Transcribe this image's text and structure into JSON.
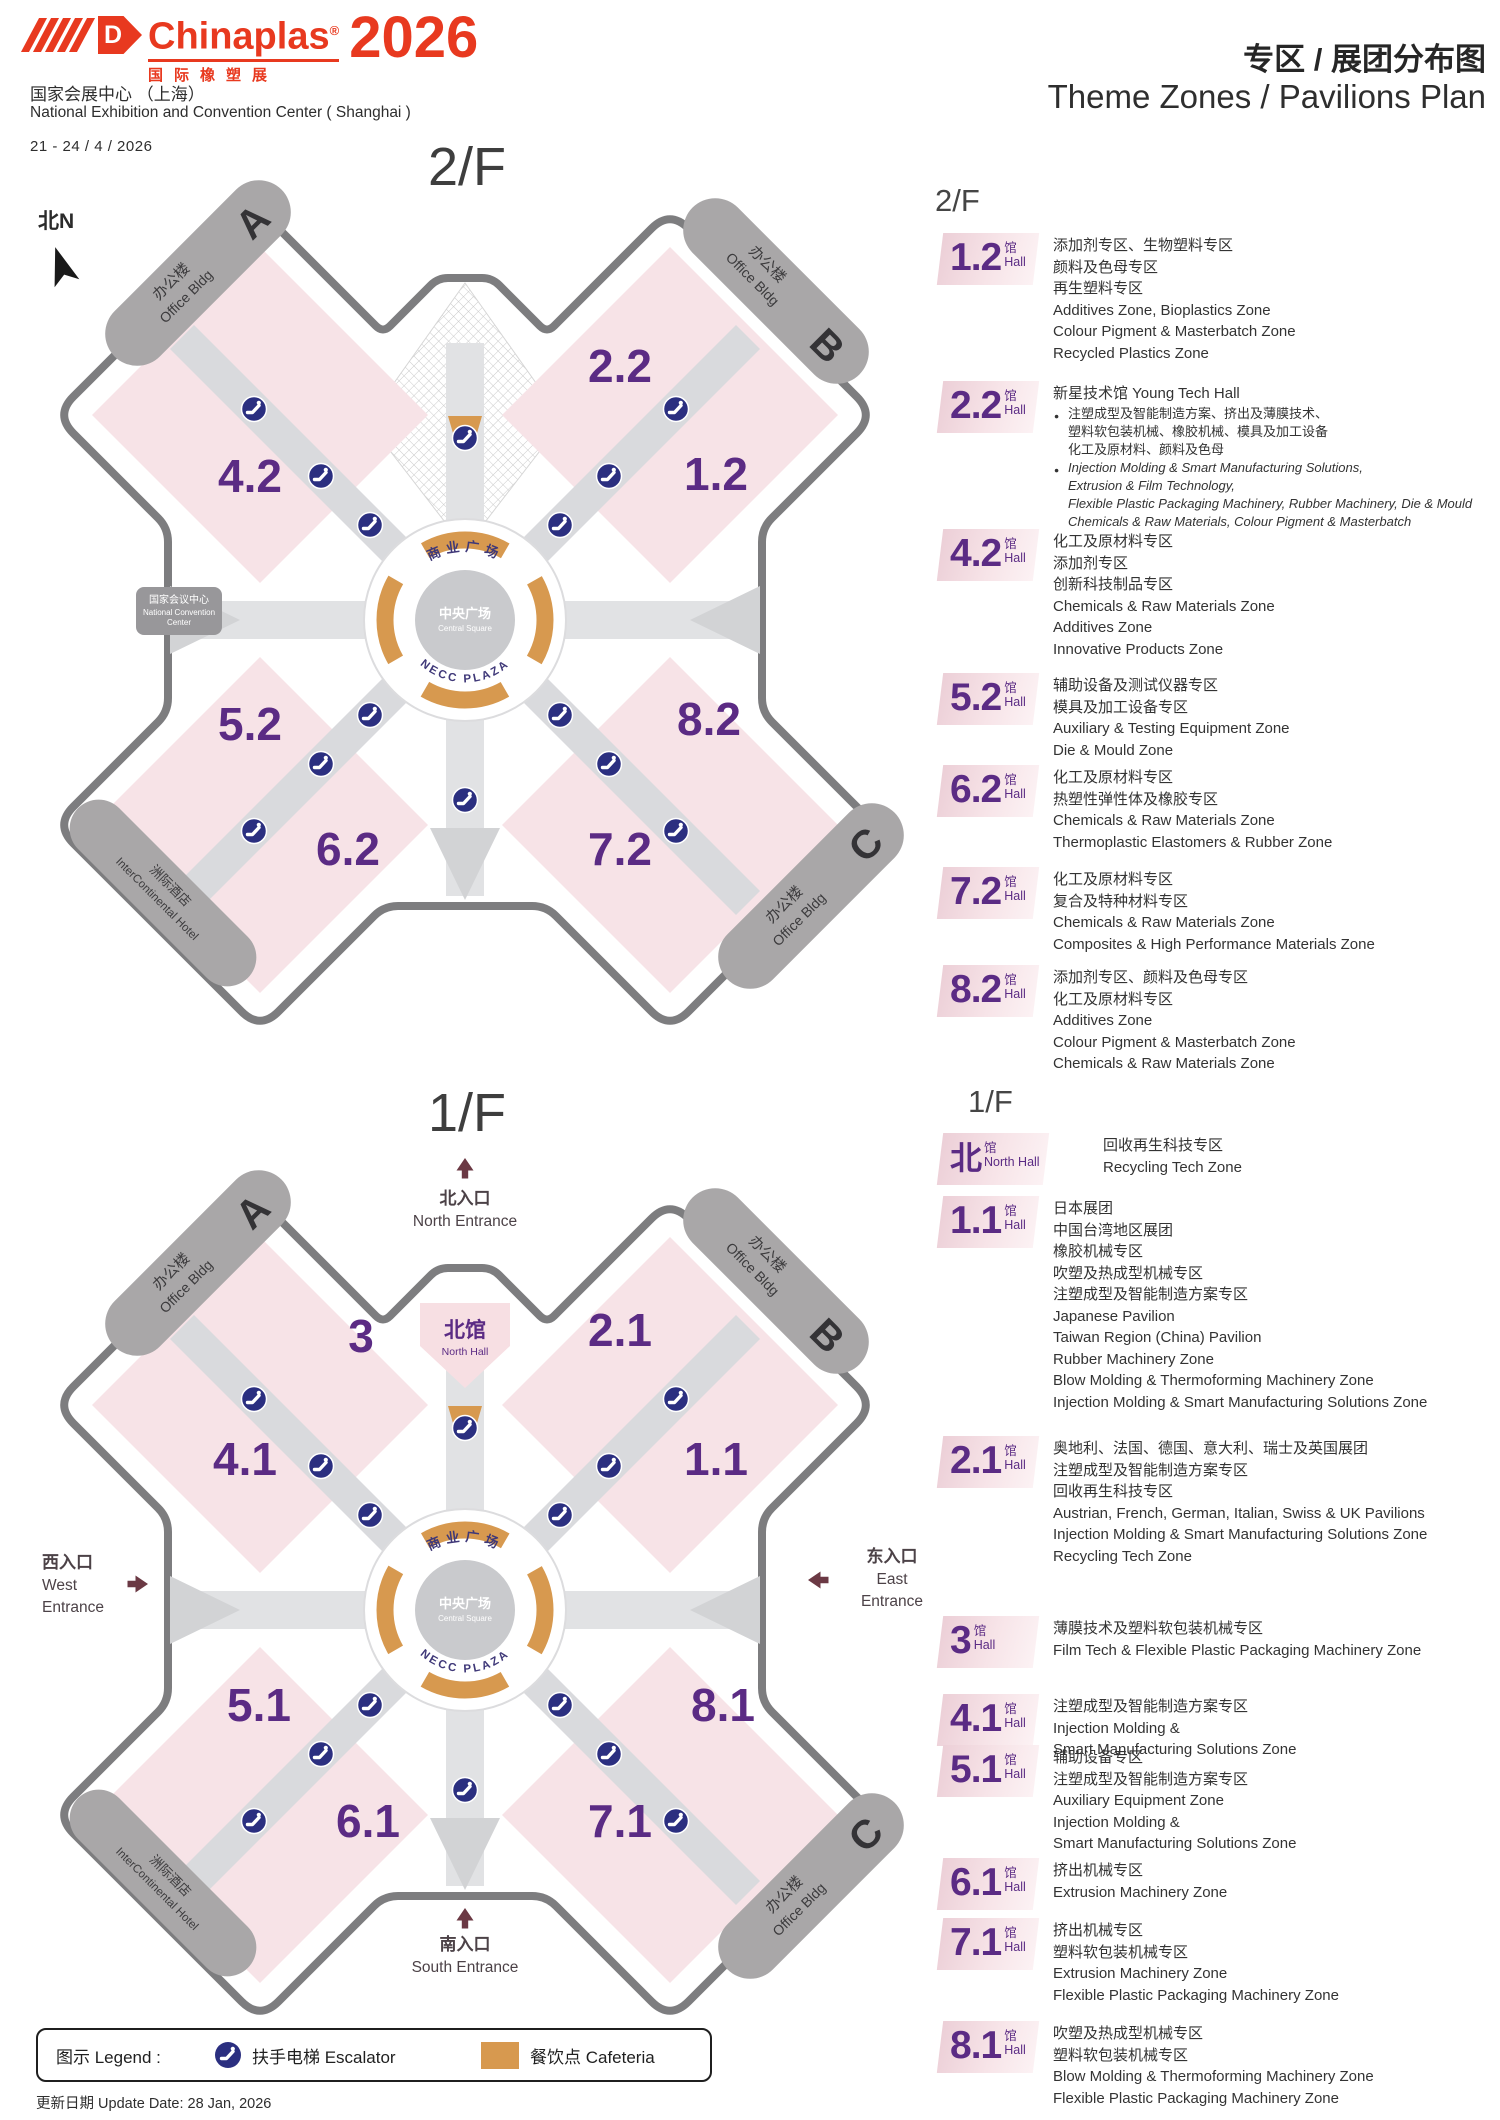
{
  "header": {
    "brand": "Chinaplas",
    "reg": "®",
    "brand_cn": "国际橡塑展",
    "year": "2026",
    "logo_d": "D",
    "venue_cn": "国家会展中心 （上海）",
    "venue_en": "National Exhibition and Convention Center ( Shanghai )",
    "dates": "21 - 24 / 4 / 2026",
    "title_cn": "专区 / 展团分布图",
    "title_en": "Theme Zones / Pavilions Plan"
  },
  "colors": {
    "brand_red": "#e8391f",
    "hall_purple": "#5b2b84",
    "hall_pink": "#f7e3e7",
    "cafeteria_orange": "#d7994f",
    "escalator_navy": "#2b2f80",
    "building_gray": "#a9a7a8",
    "outline_gray": "#7d7d7f"
  },
  "maps": {
    "common": {
      "plaza": {
        "arc_top": "商业广场",
        "center_cn": "中央广场",
        "center_en": "Central Square",
        "arc_bottom": "NECC PLAZA"
      },
      "buildings": {
        "office_cn": "办公楼",
        "office_en": "Office Bldg",
        "a": "A",
        "b": "B",
        "c": "C",
        "hotel_cn": "洲际酒店",
        "hotel_en": "InterContinental Hotel"
      }
    },
    "floor2": {
      "title": "2/F",
      "compass": "北N",
      "ncc": [
        "国家会议中心",
        "National Convention",
        "Center"
      ],
      "halls": [
        {
          "label": "2.2",
          "x": 602,
          "y": 242
        },
        {
          "label": "1.2",
          "x": 698,
          "y": 350
        },
        {
          "label": "4.2",
          "x": 232,
          "y": 352
        },
        {
          "label": "5.2",
          "x": 232,
          "y": 600
        },
        {
          "label": "8.2",
          "x": 691,
          "y": 595
        },
        {
          "label": "6.2",
          "x": 330,
          "y": 725
        },
        {
          "label": "7.2",
          "x": 602,
          "y": 725
        }
      ]
    },
    "floor1": {
      "title": "1/F",
      "north_hall_cn": "北馆",
      "north_hall_en": "North Hall",
      "halls": [
        {
          "label": "3",
          "x": 343,
          "y": 222
        },
        {
          "label": "2.1",
          "x": 602,
          "y": 216
        },
        {
          "label": "4.1",
          "x": 227,
          "y": 345
        },
        {
          "label": "1.1",
          "x": 698,
          "y": 345
        },
        {
          "label": "5.1",
          "x": 241,
          "y": 591
        },
        {
          "label": "8.1",
          "x": 705,
          "y": 591
        },
        {
          "label": "6.1",
          "x": 350,
          "y": 707
        },
        {
          "label": "7.1",
          "x": 602,
          "y": 707
        }
      ],
      "entrances": {
        "north": {
          "cn": "北入口",
          "en": "North Entrance"
        },
        "south": {
          "cn": "南入口",
          "en": "South Entrance"
        },
        "west": {
          "cn": "西入口",
          "en_l1": "West",
          "en_l2": "Entrance"
        },
        "east": {
          "cn": "东入口",
          "en_l1": "East",
          "en_l2": "Entrance"
        }
      }
    }
  },
  "legend2f": {
    "heading": "2/F",
    "entries": [
      {
        "num": "1.2",
        "unit": "馆",
        "unit2": "Hall",
        "lines": [
          {
            "t": "添加剂专区、生物塑料专区",
            "s": "cn"
          },
          {
            "t": "颜料及色母专区",
            "s": "cn"
          },
          {
            "t": "再生塑料专区",
            "s": "cn"
          },
          {
            "t": "Additives Zone, Bioplastics Zone",
            "s": "en"
          },
          {
            "t": "Colour Pigment & Masterbatch Zone",
            "s": "en"
          },
          {
            "t": "Recycled Plastics Zone",
            "s": "en"
          }
        ]
      },
      {
        "num": "2.2",
        "unit": "馆",
        "unit2": "Hall",
        "lines": [
          {
            "t": "新星技术馆 Young Tech Hall",
            "s": "cn"
          },
          {
            "t": "注塑成型及智能制造方案、挤出及薄膜技术、",
            "s": "bcn",
            "b": 1
          },
          {
            "t": "塑料软包装机械、橡胶机械、模具及加工设备",
            "s": "bcn"
          },
          {
            "t": "化工及原材料、颜料及色母",
            "s": "bcn"
          },
          {
            "t": "Injection Molding & Smart Manufacturing Solutions,",
            "s": "ben",
            "b": 1
          },
          {
            "t": "Extrusion & Film Technology,",
            "s": "ben"
          },
          {
            "t": "Flexible Plastic Packaging Machinery, Rubber Machinery, Die & Mould",
            "s": "ben"
          },
          {
            "t": "Chemicals & Raw Materials, Colour Pigment & Masterbatch",
            "s": "ben"
          }
        ]
      },
      {
        "num": "4.2",
        "unit": "馆",
        "unit2": "Hall",
        "lines": [
          {
            "t": "化工及原材料专区",
            "s": "cn"
          },
          {
            "t": "添加剂专区",
            "s": "cn"
          },
          {
            "t": "创新科技制品专区",
            "s": "cn"
          },
          {
            "t": "Chemicals & Raw Materials Zone",
            "s": "en"
          },
          {
            "t": "Additives Zone",
            "s": "en"
          },
          {
            "t": "Innovative Products Zone",
            "s": "en"
          }
        ]
      },
      {
        "num": "5.2",
        "unit": "馆",
        "unit2": "Hall",
        "lines": [
          {
            "t": "辅助设备及测试仪器专区",
            "s": "cn"
          },
          {
            "t": "模具及加工设备专区",
            "s": "cn"
          },
          {
            "t": "Auxiliary & Testing Equipment Zone",
            "s": "en"
          },
          {
            "t": "Die & Mould Zone",
            "s": "en"
          }
        ]
      },
      {
        "num": "6.2",
        "unit": "馆",
        "unit2": "Hall",
        "lines": [
          {
            "t": "化工及原材料专区",
            "s": "cn"
          },
          {
            "t": "热塑性弹性体及橡胶专区",
            "s": "cn"
          },
          {
            "t": "Chemicals & Raw Materials Zone",
            "s": "en"
          },
          {
            "t": "Thermoplastic Elastomers & Rubber Zone",
            "s": "en"
          }
        ]
      },
      {
        "num": "7.2",
        "unit": "馆",
        "unit2": "Hall",
        "lines": [
          {
            "t": "化工及原材料专区",
            "s": "cn"
          },
          {
            "t": "复合及特种材料专区",
            "s": "cn"
          },
          {
            "t": "Chemicals & Raw Materials Zone",
            "s": "en"
          },
          {
            "t": "Composites & High Performance Materials Zone",
            "s": "en"
          }
        ]
      },
      {
        "num": "8.2",
        "unit": "馆",
        "unit2": "Hall",
        "lines": [
          {
            "t": "添加剂专区、颜料及色母专区",
            "s": "cn"
          },
          {
            "t": "化工及原材料专区",
            "s": "cn"
          },
          {
            "t": "Additives Zone",
            "s": "en"
          },
          {
            "t": "Colour Pigment & Masterbatch Zone",
            "s": "en"
          },
          {
            "t": "Chemicals & Raw Materials Zone",
            "s": "en"
          }
        ]
      }
    ]
  },
  "legend1f": {
    "heading": "1/F",
    "entries": [
      {
        "num": "北",
        "unit": "馆",
        "unit2": "North Hall",
        "lines": [
          {
            "t": "回收再生科技专区",
            "s": "cn"
          },
          {
            "t": "Recycling Tech Zone",
            "s": "en"
          }
        ]
      },
      {
        "num": "1.1",
        "unit": "馆",
        "unit2": "Hall",
        "lines": [
          {
            "t": "日本展团",
            "s": "cn"
          },
          {
            "t": "中国台湾地区展团",
            "s": "cn"
          },
          {
            "t": "橡胶机械专区",
            "s": "cn"
          },
          {
            "t": "吹塑及热成型机械专区",
            "s": "cn"
          },
          {
            "t": "注塑成型及智能制造方案专区",
            "s": "cn"
          },
          {
            "t": "Japanese Pavilion",
            "s": "en"
          },
          {
            "t": "Taiwan Region (China) Pavilion",
            "s": "en"
          },
          {
            "t": "Rubber Machinery Zone",
            "s": "en"
          },
          {
            "t": "Blow Molding & Thermoforming Machinery Zone",
            "s": "en"
          },
          {
            "t": "Injection Molding & Smart Manufacturing Solutions Zone",
            "s": "en"
          }
        ]
      },
      {
        "num": "2.1",
        "unit": "馆",
        "unit2": "Hall",
        "lines": [
          {
            "t": "奥地利、法国、德国、意大利、瑞士及英国展团",
            "s": "cn"
          },
          {
            "t": "注塑成型及智能制造方案专区",
            "s": "cn"
          },
          {
            "t": "回收再生科技专区",
            "s": "cn"
          },
          {
            "t": "Austrian, French, German, Italian, Swiss & UK Pavilions",
            "s": "en"
          },
          {
            "t": "Injection Molding & Smart Manufacturing Solutions Zone",
            "s": "en"
          },
          {
            "t": "Recycling Tech Zone",
            "s": "en"
          }
        ]
      },
      {
        "num": "3",
        "unit": "馆",
        "unit2": "Hall",
        "lines": [
          {
            "t": "薄膜技术及塑料软包装机械专区",
            "s": "cn"
          },
          {
            "t": "Film Tech &  Flexible Plastic Packaging Machinery Zone",
            "s": "en"
          }
        ]
      },
      {
        "num": "4.1",
        "unit": "馆",
        "unit2": "Hall",
        "lines": [
          {
            "t": "注塑成型及智能制造方案专区",
            "s": "cn"
          },
          {
            "t": "Injection Molding &",
            "s": "en"
          },
          {
            "t": "Smart Manufacturing Solutions Zone",
            "s": "en"
          }
        ]
      },
      {
        "num": "5.1",
        "unit": "馆",
        "unit2": "Hall",
        "lines": [
          {
            "t": "辅助设备专区",
            "s": "cn"
          },
          {
            "t": "注塑成型及智能制造方案专区",
            "s": "cn"
          },
          {
            "t": "Auxiliary Equipment Zone",
            "s": "en"
          },
          {
            "t": "Injection Molding &",
            "s": "en"
          },
          {
            "t": "Smart Manufacturing Solutions Zone",
            "s": "en"
          }
        ]
      },
      {
        "num": "6.1",
        "unit": "馆",
        "unit2": "Hall",
        "lines": [
          {
            "t": "挤出机械专区",
            "s": "cn"
          },
          {
            "t": "Extrusion Machinery Zone",
            "s": "en"
          }
        ]
      },
      {
        "num": "7.1",
        "unit": "馆",
        "unit2": "Hall",
        "lines": [
          {
            "t": "挤出机械专区",
            "s": "cn"
          },
          {
            "t": "塑料软包装机械专区",
            "s": "cn"
          },
          {
            "t": "Extrusion Machinery Zone",
            "s": "en"
          },
          {
            "t": "Flexible Plastic Packaging Machinery Zone",
            "s": "en"
          }
        ]
      },
      {
        "num": "8.1",
        "unit": "馆",
        "unit2": "Hall",
        "lines": [
          {
            "t": "吹塑及热成型机械专区",
            "s": "cn"
          },
          {
            "t": "塑料软包装机械专区",
            "s": "cn"
          },
          {
            "t": "Blow Molding & Thermoforming Machinery Zone",
            "s": "en"
          },
          {
            "t": "Flexible Plastic Packaging Machinery Zone",
            "s": "en"
          }
        ]
      }
    ]
  },
  "footer": {
    "legend_label": "图示 Legend :",
    "escalator": "扶手电梯 Escalator",
    "cafeteria": "餐饮点 Cafeteria",
    "update": "更新日期 Update Date: 28 Jan, 2026"
  }
}
